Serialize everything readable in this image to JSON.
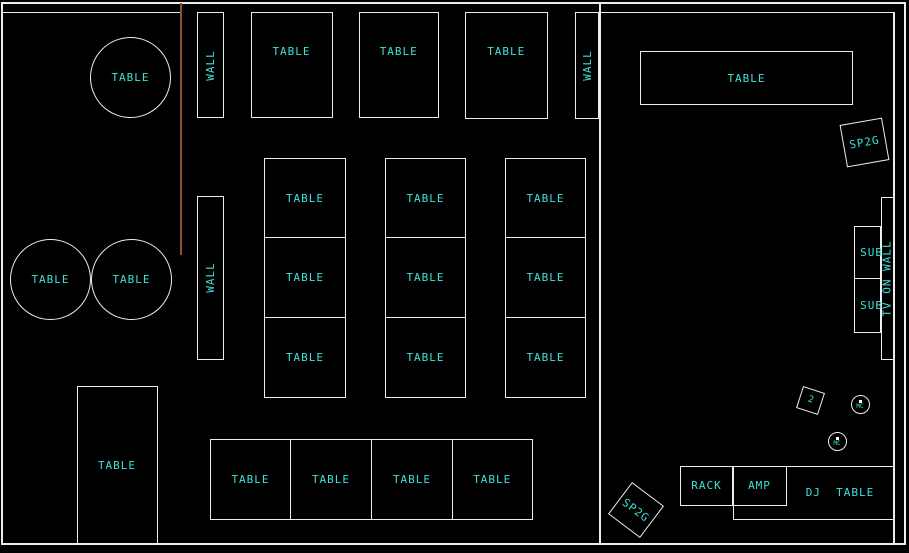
{
  "drawing_title": "venue-floor-plan",
  "colors": {
    "background": "#000000",
    "line": "#ededed",
    "text": "#3fe0d8",
    "guide_line": "#8a5434"
  },
  "canvas": {
    "width": 909,
    "height": 553
  },
  "objects": [
    {
      "name": "wall-line-top-left",
      "shape": "line",
      "x": 1,
      "y": 11.5,
      "w": 180,
      "h": 1.5
    },
    {
      "name": "guide-line",
      "shape": "line",
      "cls": "red",
      "x": 180,
      "y": 3,
      "w": 1.5,
      "h": 252
    },
    {
      "name": "wall-line-divider",
      "shape": "line",
      "x": 599,
      "y": 3,
      "w": 1.5,
      "h": 541
    },
    {
      "name": "wall-line-top-right",
      "shape": "line",
      "x": 600,
      "y": 11.5,
      "w": 294,
      "h": 1.5
    },
    {
      "name": "wall-line-right",
      "shape": "line",
      "x": 893,
      "y": 11.5,
      "w": 1.5,
      "h": 533
    },
    {
      "name": "round-table-top-left",
      "shape": "circle",
      "x": 90,
      "y": 37,
      "w": 81,
      "h": 81,
      "label": "TABLE"
    },
    {
      "name": "wall-segment-top-left",
      "shape": "rect",
      "cls": "vert",
      "x": 197,
      "y": 12,
      "w": 27,
      "h": 106,
      "label": "WALL"
    },
    {
      "name": "top-table-1",
      "shape": "rect",
      "cls": "upper",
      "x": 250.5,
      "y": 12,
      "w": 82,
      "h": 106,
      "label": "TABLE"
    },
    {
      "name": "top-table-2",
      "shape": "rect",
      "cls": "upper",
      "x": 359,
      "y": 12,
      "w": 79.5,
      "h": 106,
      "label": "TABLE"
    },
    {
      "name": "top-table-3",
      "shape": "rect",
      "cls": "upper",
      "x": 465,
      "y": 12,
      "w": 82.5,
      "h": 107,
      "label": "TABLE"
    },
    {
      "name": "wall-segment-top-right",
      "shape": "rect",
      "cls": "vert",
      "x": 575,
      "y": 12,
      "w": 24,
      "h": 107,
      "label": "WALL"
    },
    {
      "name": "banquet-table",
      "shape": "rect",
      "x": 640,
      "y": 51,
      "w": 213,
      "h": 54,
      "label": "TABLE"
    },
    {
      "name": "speaker-sp2g-top",
      "shape": "rect",
      "x": 842.5,
      "y": 120.5,
      "w": 43,
      "h": 43,
      "rot": -10,
      "label": "SP2G"
    },
    {
      "name": "tv-on-wall",
      "shape": "rect",
      "cls": "vert",
      "x": 881,
      "y": 197,
      "w": 13,
      "h": 163,
      "label": "TV ON WALL"
    },
    {
      "name": "sub-speaker-1",
      "shape": "rect",
      "cls": "subright",
      "x": 853.5,
      "y": 226,
      "w": 27.5,
      "h": 53,
      "label": "SUB"
    },
    {
      "name": "sub-speaker-2",
      "shape": "rect",
      "cls": "subright",
      "x": 853.5,
      "y": 278,
      "w": 27.5,
      "h": 55,
      "label": "SUB"
    },
    {
      "name": "grid-table-r1c1",
      "shape": "rect",
      "x": 264,
      "y": 158,
      "w": 82,
      "h": 80,
      "label": "TABLE"
    },
    {
      "name": "grid-table-r1c2",
      "shape": "rect",
      "x": 385,
      "y": 158,
      "w": 81,
      "h": 80,
      "label": "TABLE"
    },
    {
      "name": "grid-table-r1c3",
      "shape": "rect",
      "x": 505,
      "y": 158,
      "w": 81,
      "h": 80,
      "label": "TABLE"
    },
    {
      "name": "grid-table-r2c1",
      "shape": "rect",
      "x": 264,
      "y": 237,
      "w": 82,
      "h": 81,
      "label": "TABLE"
    },
    {
      "name": "grid-table-r2c2",
      "shape": "rect",
      "x": 385,
      "y": 237,
      "w": 81,
      "h": 81,
      "label": "TABLE"
    },
    {
      "name": "grid-table-r2c3",
      "shape": "rect",
      "x": 505,
      "y": 237,
      "w": 81,
      "h": 81,
      "label": "TABLE"
    },
    {
      "name": "grid-table-r3c1",
      "shape": "rect",
      "x": 264,
      "y": 317,
      "w": 82,
      "h": 81,
      "label": "TABLE"
    },
    {
      "name": "grid-table-r3c2",
      "shape": "rect",
      "x": 385,
      "y": 317,
      "w": 81,
      "h": 81,
      "label": "TABLE"
    },
    {
      "name": "grid-table-r3c3",
      "shape": "rect",
      "x": 505,
      "y": 317,
      "w": 81,
      "h": 81,
      "label": "TABLE"
    },
    {
      "name": "round-table-left-1",
      "shape": "circle",
      "x": 10,
      "y": 239,
      "w": 81,
      "h": 81,
      "label": "TABLE"
    },
    {
      "name": "round-table-left-2",
      "shape": "circle",
      "x": 91,
      "y": 239,
      "w": 81,
      "h": 81,
      "label": "TABLE"
    },
    {
      "name": "wall-segment-middle",
      "shape": "rect",
      "cls": "vert",
      "x": 197,
      "y": 196,
      "w": 26.5,
      "h": 163.5,
      "label": "WALL"
    },
    {
      "name": "tall-table",
      "shape": "rect",
      "x": 76.5,
      "y": 386,
      "w": 81,
      "h": 158,
      "label": "TABLE"
    },
    {
      "name": "bottom-table-1",
      "shape": "rect",
      "x": 210,
      "y": 439,
      "w": 81,
      "h": 81,
      "label": "TABLE"
    },
    {
      "name": "bottom-table-2",
      "shape": "rect",
      "x": 290,
      "y": 439,
      "w": 82,
      "h": 81,
      "label": "TABLE"
    },
    {
      "name": "bottom-table-3",
      "shape": "rect",
      "x": 371,
      "y": 439,
      "w": 82,
      "h": 81,
      "label": "TABLE"
    },
    {
      "name": "bottom-table-4",
      "shape": "rect",
      "x": 452,
      "y": 439,
      "w": 80.5,
      "h": 81,
      "label": "TABLE"
    },
    {
      "name": "monitor-speaker",
      "shape": "rect",
      "cls": "tiny",
      "x": 799,
      "y": 389,
      "w": 23,
      "h": 23,
      "rot": 18,
      "label": "2"
    },
    {
      "name": "mic-circle-1",
      "shape": "circle",
      "cls": "mic",
      "x": 850.5,
      "y": 395,
      "w": 19,
      "h": 19,
      "label": "MC"
    },
    {
      "name": "mic-circle-2",
      "shape": "circle",
      "cls": "mic",
      "x": 827.5,
      "y": 432,
      "w": 19,
      "h": 19,
      "label": "MC"
    },
    {
      "name": "rack",
      "shape": "rect",
      "x": 680,
      "y": 465.5,
      "w": 53,
      "h": 40.5,
      "label": "RACK"
    },
    {
      "name": "amp",
      "shape": "rect",
      "x": 732.5,
      "y": 465.5,
      "w": 54,
      "h": 40.5,
      "label": "AMP"
    },
    {
      "name": "dj-table",
      "shape": "rect",
      "cls": "dj",
      "x": 732.5,
      "y": 465.5,
      "w": 161,
      "h": 54,
      "label": "DJ  TABLE"
    },
    {
      "name": "speaker-sp2g-bottom",
      "shape": "rect",
      "x": 616,
      "y": 489.5,
      "w": 40,
      "h": 40,
      "rot": 37,
      "label": "SP2G"
    }
  ]
}
